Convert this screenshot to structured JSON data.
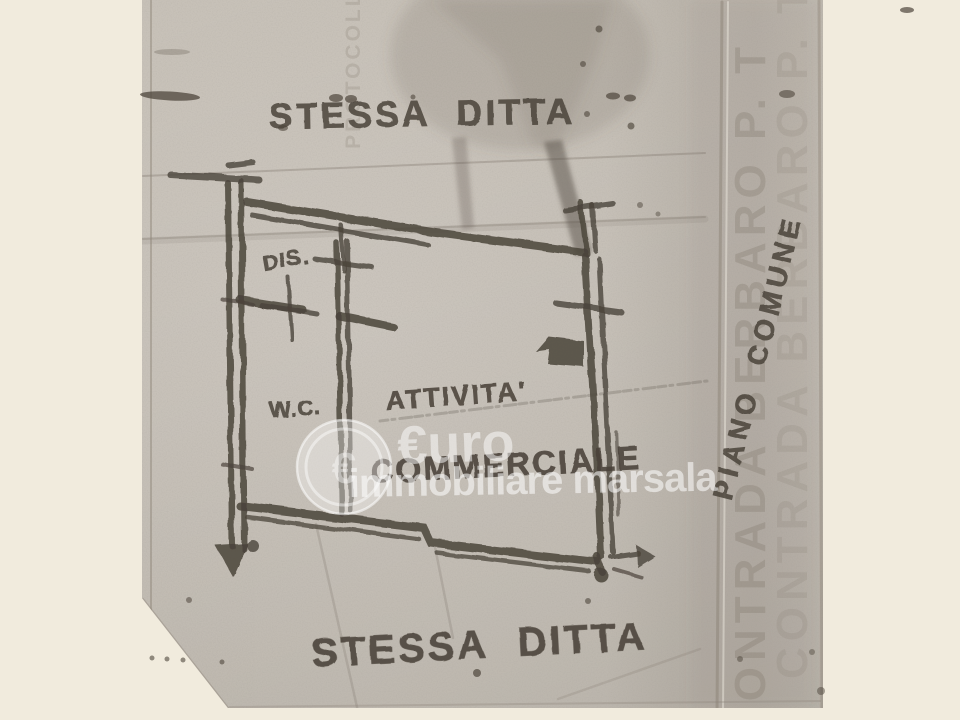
{
  "document": {
    "captions": {
      "top": "STESSA DITTA",
      "bottom": "STESSA DITTA",
      "side_vertical": "PIANO COMUNE"
    },
    "rooms": {
      "dis": "DIS.",
      "wc": "W.C.",
      "main_line1": "ATTIVITA'",
      "main_line2": "COMMERCIALE"
    },
    "ghost_text": {
      "right_column": "CONTRADA BERBARO P. T",
      "top_left_column": "PROTOCOLLO"
    }
  },
  "watermark": {
    "euro_wordmark": "€uro",
    "brand": "immobiliare marsala",
    "coin_symbol": "€"
  },
  "colors": {
    "marker": "#4a433a",
    "paper": "#c9c3ba",
    "photo_background": "#f1ebdd",
    "watermark": "#ffffff"
  }
}
